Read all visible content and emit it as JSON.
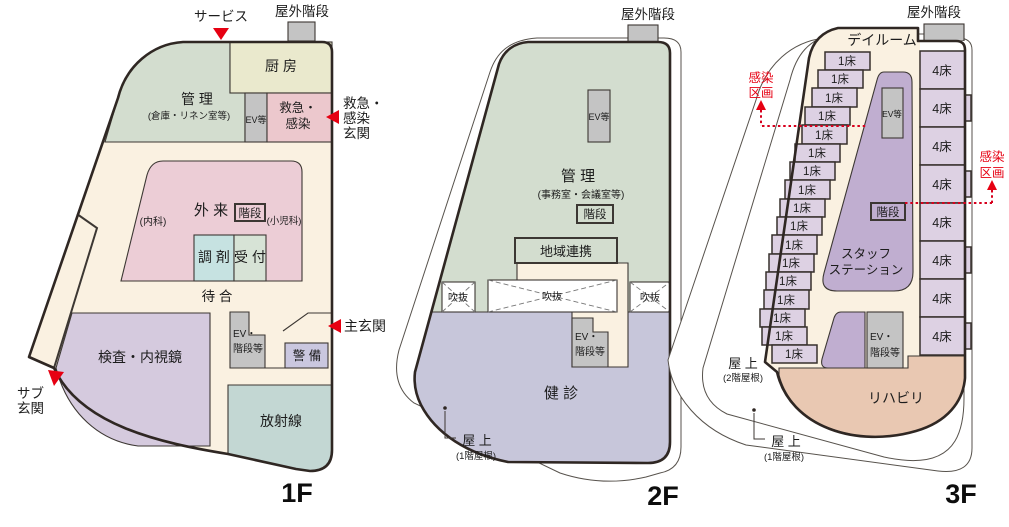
{
  "diagram_title": "病院フロアプラン（1F・2F・3F）",
  "colors": {
    "floor_cream": "#faf1e1",
    "admin_sage": "#d3ddcf",
    "kitchen_beige": "#eae9cd",
    "emergency_pink": "#ecc8cd",
    "outpatient_pink": "#eccdd6",
    "dispensary_teal": "#c6e2e1",
    "reception_green": "#d7e3d6",
    "ev_gray": "#c4c4c4",
    "exam_purple": "#d5cade",
    "security_lavender": "#cac7df",
    "radiology_teal": "#c3d7d3",
    "checkup_purple": "#c7c6da",
    "room_purple": "#ddd1e3",
    "staff_purple": "#c0aed0",
    "stairs_light": "#f3eef4",
    "rehab_tan": "#e9c8b2",
    "accent_red": "#e60012",
    "outline_dark": "#2f2723",
    "white": "#ffffff"
  },
  "floors": {
    "f1": {
      "floor_label": "1F",
      "outdoor_stairs": "屋外階段",
      "service": "サービス",
      "kitchen": "厨 房",
      "admin": "管 理",
      "admin_sub": "(倉庫・リネン室等)",
      "ev": "EV等",
      "emergency_room": [
        "救急・",
        "感染"
      ],
      "emergency_entrance": [
        "救急・",
        "感染",
        "玄関"
      ],
      "outpatient": "外 来",
      "internal_medicine": "(内科)",
      "stairs": "階段",
      "pediatrics": "(小児科)",
      "dispensary": "調 剤",
      "reception": "受 付",
      "waiting": "待 合",
      "exam": "検査・内視鏡",
      "ev_stairs": [
        "EV・",
        "階段等"
      ],
      "security": "警 備",
      "main_entrance": "主玄関",
      "radiology": "放射線",
      "sub_entrance": [
        "サブ",
        "玄関"
      ]
    },
    "f2": {
      "floor_label": "2F",
      "outdoor_stairs": "屋外階段",
      "ev": "EV等",
      "admin": "管 理",
      "admin_sub": "(事務室・会議室等)",
      "stairs": "階段",
      "regional": "地域連携",
      "void1": "吹抜",
      "void2": "吹抜",
      "void3": "吹抜",
      "ev_stairs": [
        "EV・",
        "階段等"
      ],
      "checkup": "健 診",
      "rooftop": "屋 上",
      "rooftop_sub": "(1階屋根)"
    },
    "f3": {
      "floor_label": "3F",
      "outdoor_stairs": "屋外階段",
      "dayroom": "デイルーム",
      "bed1": "1床",
      "bed4": "4床",
      "ev": "EV等",
      "stairs": "階段",
      "staff_station": [
        "スタッフ",
        "ステーション"
      ],
      "ev_stairs": [
        "EV・",
        "階段等"
      ],
      "rehab": "リハビリ",
      "infection_zone": [
        "感染",
        "区画"
      ],
      "rooftop2": "屋 上",
      "rooftop2_sub": "(2階屋根)",
      "rooftop1": "屋 上",
      "rooftop1_sub": "(1階屋根)"
    }
  }
}
